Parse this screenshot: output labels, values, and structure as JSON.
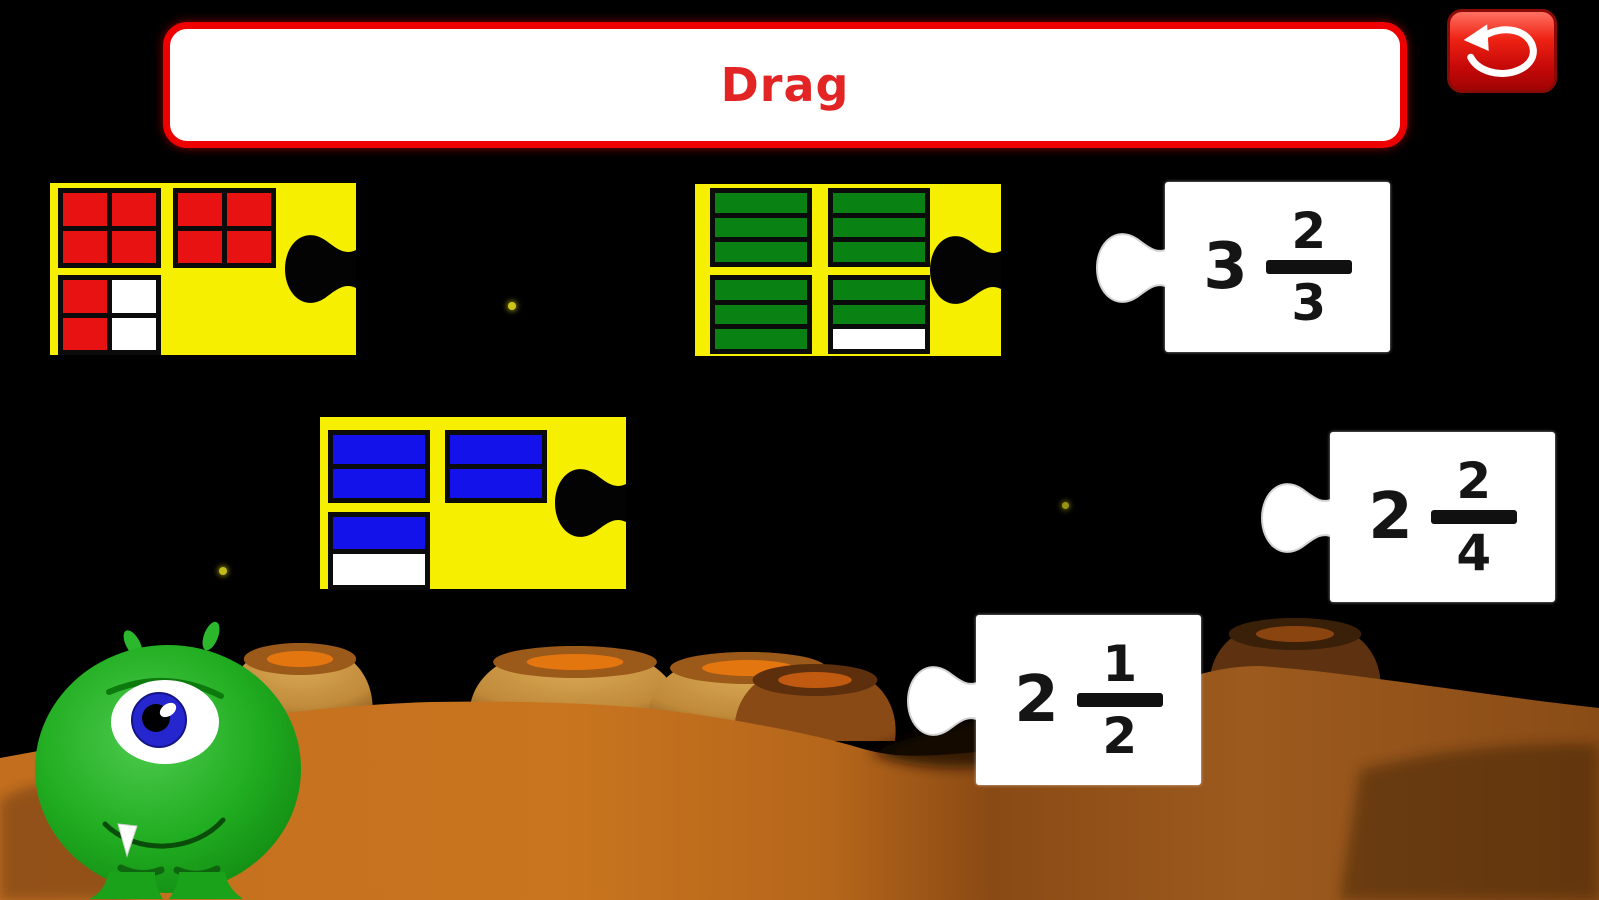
{
  "game": {
    "instruction": "Drag",
    "toolbar": {
      "undo_label": "undo"
    }
  },
  "pieces": {
    "fraction_cards": [
      {
        "name": "red-squares-card",
        "represents": "2 2/4",
        "fill": "#e81212",
        "block_cols": 2,
        "block_w": 103,
        "block_heights": [
          80,
          80,
          80
        ],
        "block_positions": [
          [
            8,
            5
          ],
          [
            123,
            5
          ],
          [
            8,
            92
          ]
        ],
        "blocks": [
          [
            "1",
            "1",
            "1",
            "1"
          ],
          [
            "1",
            "1",
            "1",
            "1"
          ],
          [
            "1",
            "0",
            "1",
            "0"
          ]
        ]
      },
      {
        "name": "green-bars-card",
        "represents": "3 2/3",
        "fill": "#0a8113",
        "block_cols": 1,
        "block_w": 102,
        "block_heights": [
          79,
          79,
          79,
          79
        ],
        "block_positions": [
          [
            15,
            4
          ],
          [
            133,
            4
          ],
          [
            15,
            91
          ],
          [
            133,
            91
          ]
        ],
        "blocks": [
          [
            "1",
            "1",
            "1"
          ],
          [
            "1",
            "1",
            "1"
          ],
          [
            "1",
            "1",
            "1"
          ],
          [
            "1",
            "1",
            "0"
          ]
        ]
      },
      {
        "name": "blue-bars-card",
        "represents": "2 1/2",
        "fill": "#1412ea",
        "block_cols": 1,
        "block_w": 102,
        "block_heights": [
          73,
          73,
          78
        ],
        "block_positions": [
          [
            8,
            13
          ],
          [
            125,
            13
          ],
          [
            8,
            95
          ]
        ],
        "blocks": [
          [
            "1",
            "1"
          ],
          [
            "1",
            "1"
          ],
          [
            "1",
            "0"
          ]
        ]
      }
    ],
    "number_cards": [
      {
        "name": "mixed-number-3-2-3",
        "whole": "3",
        "numerator": "2",
        "denominator": "3"
      },
      {
        "name": "mixed-number-2-2-4",
        "whole": "2",
        "numerator": "2",
        "denominator": "4"
      },
      {
        "name": "mixed-number-2-1-2",
        "whole": "2",
        "numerator": "1",
        "denominator": "2"
      }
    ]
  },
  "scene": {
    "character": "green one-eyed alien",
    "stars": [
      {
        "x": 508,
        "y": 302,
        "size": 8,
        "brightness": 1
      },
      {
        "x": 1062,
        "y": 502,
        "size": 7,
        "brightness": 0.75
      },
      {
        "x": 219,
        "y": 567,
        "size": 8,
        "brightness": 0.95
      }
    ],
    "mounds": [
      {
        "cx": 300,
        "top": 643,
        "hw": 72,
        "shade": "bright"
      },
      {
        "cx": 575,
        "top": 646,
        "hw": 105,
        "shade": "bright"
      },
      {
        "cx": 748,
        "top": 652,
        "hw": 100,
        "shade": "bright"
      },
      {
        "cx": 815,
        "top": 664,
        "hw": 80,
        "shade": "mid"
      },
      {
        "cx": 1295,
        "top": 618,
        "hw": 85,
        "shade": "dark"
      }
    ]
  },
  "colors": {
    "background": "#000000",
    "puzzle_yellow": "#f6ef00",
    "cell_red": "#e81212",
    "cell_green": "#0a8113",
    "cell_blue": "#1412ea",
    "cell_empty": "#ffffff",
    "banner_border": "#ee0000",
    "banner_text": "#e32424",
    "button_red": "#ee2213",
    "ground_orange": "#c4701e",
    "ground_dark": "#6e3a10",
    "star_yellow": "#cdc41a",
    "alien_green": "#21ad21"
  }
}
